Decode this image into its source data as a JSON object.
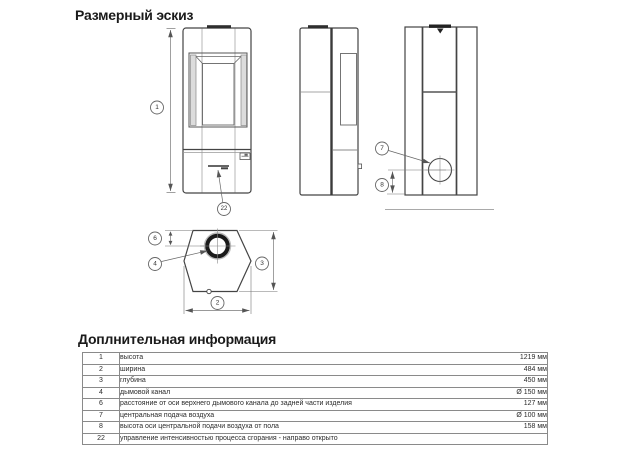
{
  "page": {
    "title": "Размерный эскиз",
    "info_title": "Доплнительная информация"
  },
  "drawing": {
    "callouts": {
      "height": "1",
      "width": "2",
      "depth": "3",
      "flue": "4",
      "flue_offset": "6",
      "air_supply": "7",
      "air_height": "8",
      "control": "22"
    }
  },
  "table": {
    "rows": [
      {
        "num": "1",
        "desc": "высота",
        "value": "1219 мм"
      },
      {
        "num": "2",
        "desc": "ширина",
        "value": "484 мм"
      },
      {
        "num": "3",
        "desc": "глубина",
        "value": "450 мм"
      },
      {
        "num": "4",
        "desc": "дымовой канал",
        "value": "Ø 150 мм"
      },
      {
        "num": "6",
        "desc": "расстояние от оси верхнего дымового канала до задней части изделия",
        "value": "127 мм"
      },
      {
        "num": "7",
        "desc": "центральная подача воздуха",
        "value": "Ø 100 мм"
      },
      {
        "num": "8",
        "desc": "высота оси центральной подачи воздуха от пола",
        "value": "158 мм"
      },
      {
        "num": "22",
        "desc": "управление интенсивностью процесса сгорания - направо открыто",
        "value": ""
      }
    ]
  }
}
